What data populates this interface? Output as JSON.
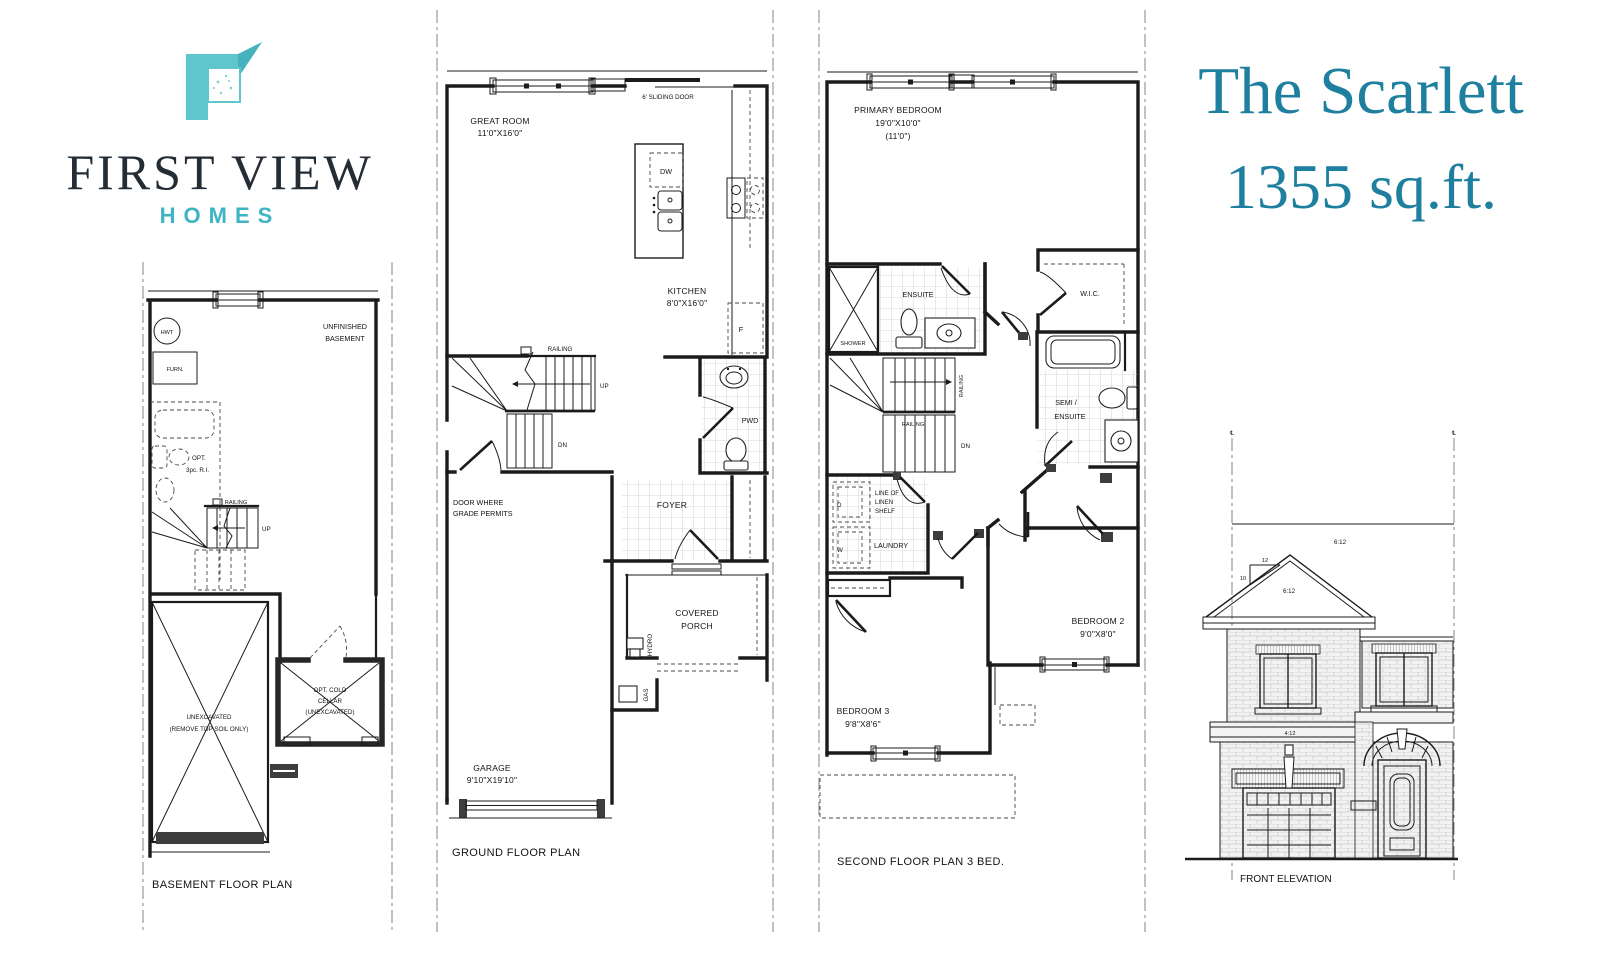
{
  "brand": {
    "firstview": "FIRST VIEW",
    "homes": "HOMES"
  },
  "title": {
    "line1": "The Scarlett",
    "line2": "1355 sq.ft."
  },
  "colors": {
    "logo_teal": "#5fc6cd",
    "logo_fold_teal": "#45b2bd",
    "homes_teal": "#3fb5c3",
    "title_teal": "#1e7f9f",
    "brand_ink": "#242c35",
    "plan_ink": "#1b1b1b"
  },
  "basement": {
    "title": "BASEMENT FLOOR PLAN",
    "hwt": "HWT",
    "furn": "FURN.",
    "unfinished_l1": "UNFINISHED",
    "unfinished_l2": "BASEMENT",
    "opt_l1": "OPT.",
    "opt_l2": "3pc. R.I.",
    "railing": "RAILING",
    "up": "UP",
    "unexcavated_l1": "UNEXCAVATED",
    "unexcavated_l2": "(REMOVE TOP SOIL ONLY)",
    "cold_l1": "OPT. COLD",
    "cold_l2": "CELLAR",
    "cold_l3": "(UNEXCAVATED)"
  },
  "ground": {
    "title": "GROUND FLOOR PLAN",
    "sliding_door": "6'  SLIDING  DOOR",
    "great_room": "GREAT ROOM",
    "great_room_dim": "11'0\"X16'0\"",
    "dw": "DW",
    "fridge": "F",
    "kitchen": "KITCHEN",
    "kitchen_dim": "8'0\"X16'0\"",
    "railing": "RAILING",
    "up": "UP",
    "dn": "DN",
    "pwd": "PWD",
    "door_grade_l1": "DOOR  WHERE",
    "door_grade_l2": "GRADE  PERMITS",
    "foyer": "FOYER",
    "porch_l1": "COVERED",
    "porch_l2": "PORCH",
    "hydro": "HYDRO",
    "gas": "GAS",
    "garage": "GARAGE",
    "garage_dim": "9'10\"X19'10\""
  },
  "second": {
    "title": "SECOND FLOOR PLAN 3 BED.",
    "primary": "PRIMARY  BEDROOM",
    "primary_dim": "19'0\"X10'0\"",
    "primary_dim2": "(11'0\")",
    "ensuite": "ENSUITE",
    "shower": "SHOWER",
    "wic": "W.I.C.",
    "railing_v": "RAILING",
    "railing": "RAILING",
    "dn": "DN",
    "semi_l1": "SEMI /",
    "semi_l2": "ENSUITE",
    "linen_l1": "LINE  OF",
    "linen_l2": "LINEN",
    "linen_l3": "SHELF",
    "dryer": "D",
    "washer": "W",
    "laundry": "LAUNDRY",
    "bedroom2": "BEDROOM 2",
    "bedroom2_dim": "9'0\"X8'0\"",
    "bedroom3": "BEDROOM 3",
    "bedroom3_dim": "9'8\"X8'6\""
  },
  "elevation": {
    "title": "FRONT ELEVATION",
    "slope_main": "6:12",
    "slope_gable": "6:12",
    "pitch_run": "12",
    "pitch_rise": "10",
    "slope_band": "4:12",
    "centerline": "℄"
  }
}
